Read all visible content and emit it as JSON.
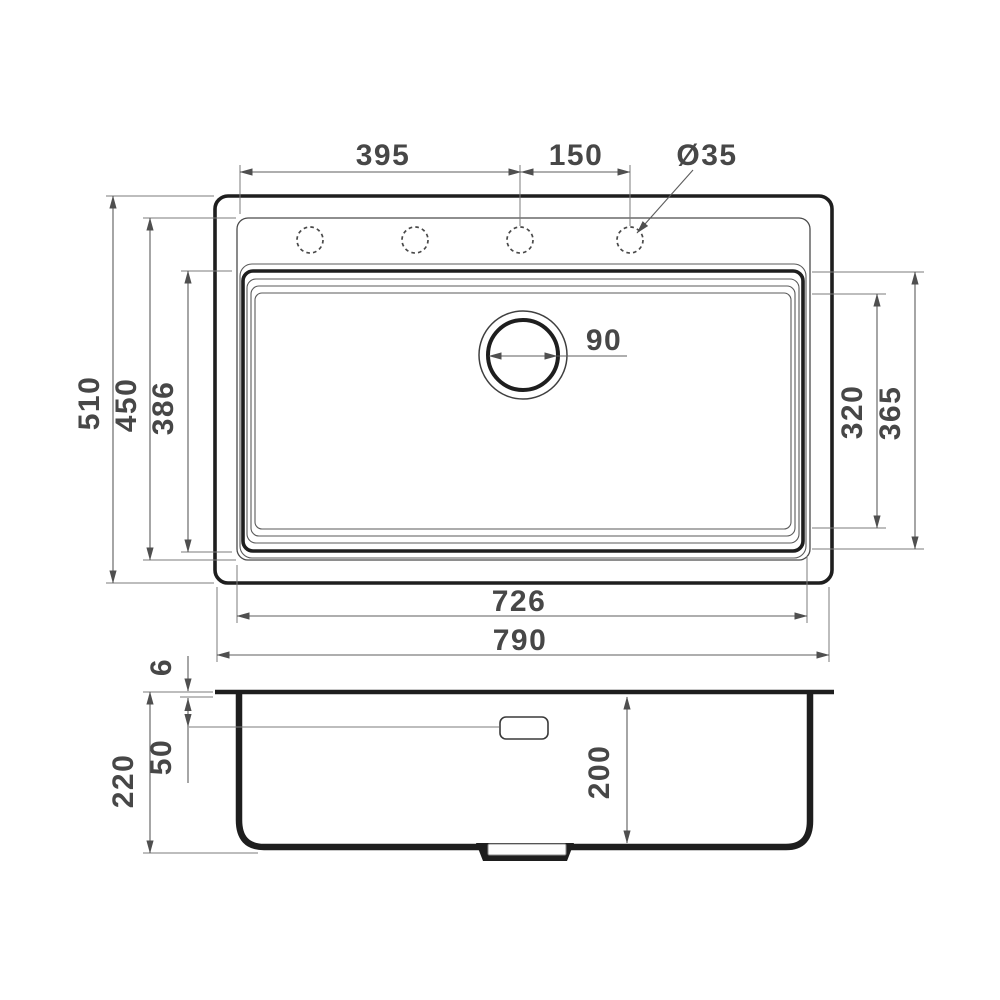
{
  "drawing": {
    "type": "technical-dimension-drawing",
    "subject": "kitchen sink, top view and section view",
    "colors": {
      "background": "#ffffff",
      "outline": "#1e1e1e",
      "dimension_lines": "#5c5c5c",
      "dimension_text": "#474747"
    },
    "top_view": {
      "faucet_hole_span": "395",
      "faucet_hole_pitch": "150",
      "faucet_hole_diameter": "Ø35",
      "drain_diameter": "90",
      "overall_height": "510",
      "deck_height": "450",
      "bowl_height": "386",
      "bowl_inner_width": "320",
      "bowl_outer_width": "365",
      "bowl_length": "726",
      "overall_length": "790",
      "faucet_hole_count": 4
    },
    "section_view": {
      "rim_thickness": "6",
      "overflow_offset": "50",
      "overall_depth": "220",
      "bowl_depth": "200"
    }
  }
}
